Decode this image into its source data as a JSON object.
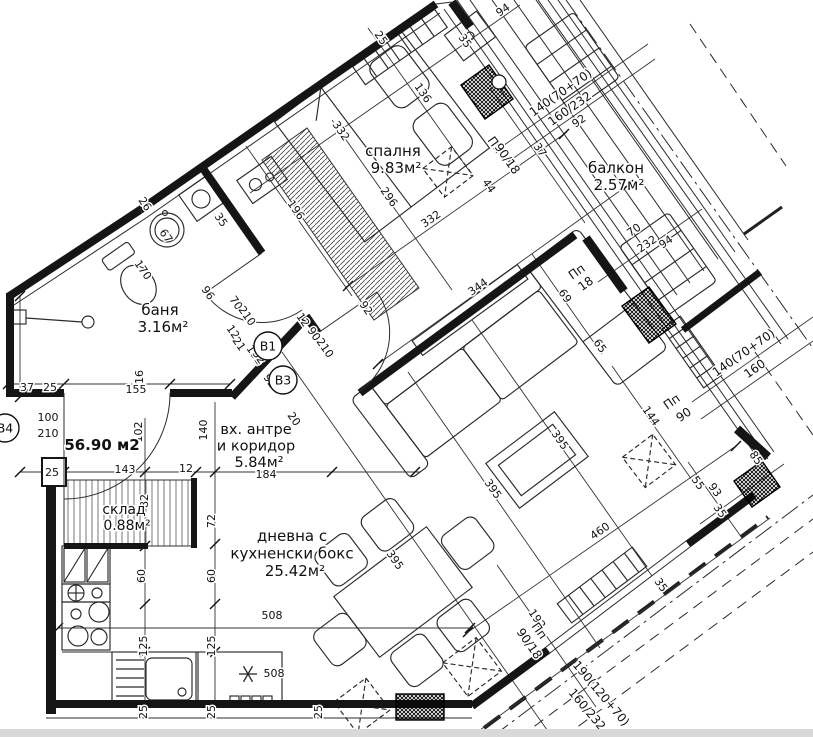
{
  "drawing_type": "apartment-floor-plan",
  "total_area": {
    "text": "56.90 м2",
    "x": 102,
    "y": 450
  },
  "rooms": [
    {
      "name_lines": [
        "спалня"
      ],
      "area": "9.83м²",
      "x": 393,
      "y": 156,
      "fs": 15,
      "lh": 17
    },
    {
      "name_lines": [
        "балкон"
      ],
      "area": "2.57м²",
      "x": 616,
      "y": 173,
      "fs": 15,
      "lh": 17
    },
    {
      "name_lines": [
        "баня"
      ],
      "area": "3.16м²",
      "x": 160,
      "y": 315,
      "fs": 15,
      "lh": 17
    },
    {
      "name_lines": [
        "вх. антре",
        "и коридор"
      ],
      "area": "5.84м²",
      "x": 256,
      "y": 434,
      "fs": 14.5,
      "lh": 16.5
    },
    {
      "name_lines": [
        "склад"
      ],
      "area": "0.88м²",
      "x": 124,
      "y": 514,
      "fs": 14,
      "lh": 16
    },
    {
      "name_lines": [
        "дневна с",
        "кухненски бокс"
      ],
      "area": "25.42м²",
      "x": 292,
      "y": 541,
      "fs": 15,
      "lh": 17.5
    }
  ],
  "door_marks": [
    {
      "label": "В1",
      "x": 268,
      "y": 346
    },
    {
      "label": "В3",
      "x": 283,
      "y": 380
    },
    {
      "label": "В4",
      "x": 5,
      "y": 428
    }
  ],
  "dim_labels": [
    [
      "332",
      338,
      133,
      55
    ],
    [
      "296",
      386,
      199,
      55
    ],
    [
      "332",
      433,
      222,
      -35
    ],
    [
      "44",
      486,
      188,
      55
    ],
    [
      "196",
      293,
      212,
      55
    ],
    [
      "26",
      142,
      206,
      55
    ],
    [
      "35",
      218,
      222,
      55
    ],
    [
      "25",
      378,
      40,
      55
    ],
    [
      "35",
      462,
      43,
      55
    ],
    [
      "136",
      420,
      95,
      55
    ],
    [
      "94",
      505,
      13,
      -35
    ],
    [
      "Пп",
      492,
      147,
      55,
      12
    ],
    [
      "90/18",
      504,
      161,
      55,
      12
    ],
    [
      "37",
      537,
      152,
      55
    ],
    [
      "140(70+70)",
      563,
      96,
      -35,
      12
    ],
    [
      "160/232",
      572,
      112,
      -35,
      12
    ],
    [
      "92",
      581,
      124,
      -35
    ],
    [
      "70",
      636,
      233,
      -35
    ],
    [
      "232",
      649,
      247,
      -35
    ],
    [
      "94",
      668,
      245,
      -35
    ],
    [
      "Пп",
      579,
      275,
      -35,
      12
    ],
    [
      "18",
      588,
      287,
      -35,
      12
    ],
    [
      "Пп",
      674,
      405,
      -35,
      12
    ],
    [
      "90",
      686,
      418,
      -35,
      12
    ],
    [
      "140(70+70)",
      746,
      356,
      -35,
      12
    ],
    [
      "160",
      757,
      372,
      -35,
      12
    ],
    [
      "344",
      480,
      290,
      -35
    ],
    [
      "69",
      562,
      298,
      55
    ],
    [
      "65",
      597,
      348,
      55
    ],
    [
      "144",
      648,
      418,
      55
    ],
    [
      "55",
      695,
      485,
      55
    ],
    [
      "93",
      712,
      492,
      55
    ],
    [
      "35",
      717,
      513,
      55
    ],
    [
      "85",
      753,
      460,
      55
    ],
    [
      "92",
      363,
      310,
      55
    ],
    [
      "12",
      300,
      322,
      55
    ],
    [
      "90",
      311,
      336,
      55
    ],
    [
      "210",
      322,
      350,
      55
    ],
    [
      "132",
      252,
      357,
      55
    ],
    [
      "70",
      233,
      305,
      55
    ],
    [
      "210",
      244,
      318,
      55
    ],
    [
      "12",
      230,
      334,
      55
    ],
    [
      "21",
      236,
      346,
      55
    ],
    [
      "32",
      256,
      359,
      55
    ],
    [
      "92",
      267,
      383,
      55
    ],
    [
      "96",
      205,
      295,
      55
    ],
    [
      "170",
      140,
      272,
      55
    ],
    [
      "67",
      163,
      238,
      55
    ],
    [
      "37",
      27,
      391,
      0
    ],
    [
      "25",
      50,
      391,
      0
    ],
    [
      "16",
      143,
      377,
      -90
    ],
    [
      "155",
      136,
      393,
      0
    ],
    [
      "100",
      48,
      421,
      0
    ],
    [
      "210",
      48,
      437,
      0
    ],
    [
      "102",
      142,
      432,
      -90
    ],
    [
      "140",
      207,
      430,
      -90
    ],
    [
      "184",
      266,
      478,
      0
    ],
    [
      "20",
      291,
      421,
      55
    ],
    [
      "25",
      52,
      476,
      0
    ],
    [
      "143",
      125,
      473,
      0
    ],
    [
      "12",
      186,
      472,
      0
    ],
    [
      "82",
      148,
      501,
      -90
    ],
    [
      "72",
      215,
      521,
      -90
    ],
    [
      "60",
      145,
      576,
      -90
    ],
    [
      "60",
      215,
      576,
      -90
    ],
    [
      "125",
      147,
      646,
      -90
    ],
    [
      "125",
      215,
      646,
      -90
    ],
    [
      "25",
      147,
      712,
      -90
    ],
    [
      "25",
      215,
      712,
      -90
    ],
    [
      "25",
      322,
      712,
      -90
    ],
    [
      "508",
      272,
      619,
      0
    ],
    [
      "508",
      274,
      677,
      0
    ],
    [
      "395",
      392,
      562,
      55
    ],
    [
      "395",
      490,
      491,
      55
    ],
    [
      "395",
      557,
      442,
      55
    ],
    [
      "460",
      602,
      534,
      -35
    ],
    [
      "192",
      534,
      621,
      55
    ],
    [
      "Пп",
      536,
      633,
      55,
      12
    ],
    [
      "90/18",
      526,
      646,
      55,
      12
    ],
    [
      "35",
      658,
      587,
      55
    ],
    [
      "190(120+70)",
      598,
      696,
      50,
      12
    ],
    [
      "160/232",
      584,
      712,
      50,
      12
    ]
  ],
  "colors": {
    "line": "#151515",
    "paper": "#ffffff",
    "footer_strip": "#d9d9d9"
  }
}
